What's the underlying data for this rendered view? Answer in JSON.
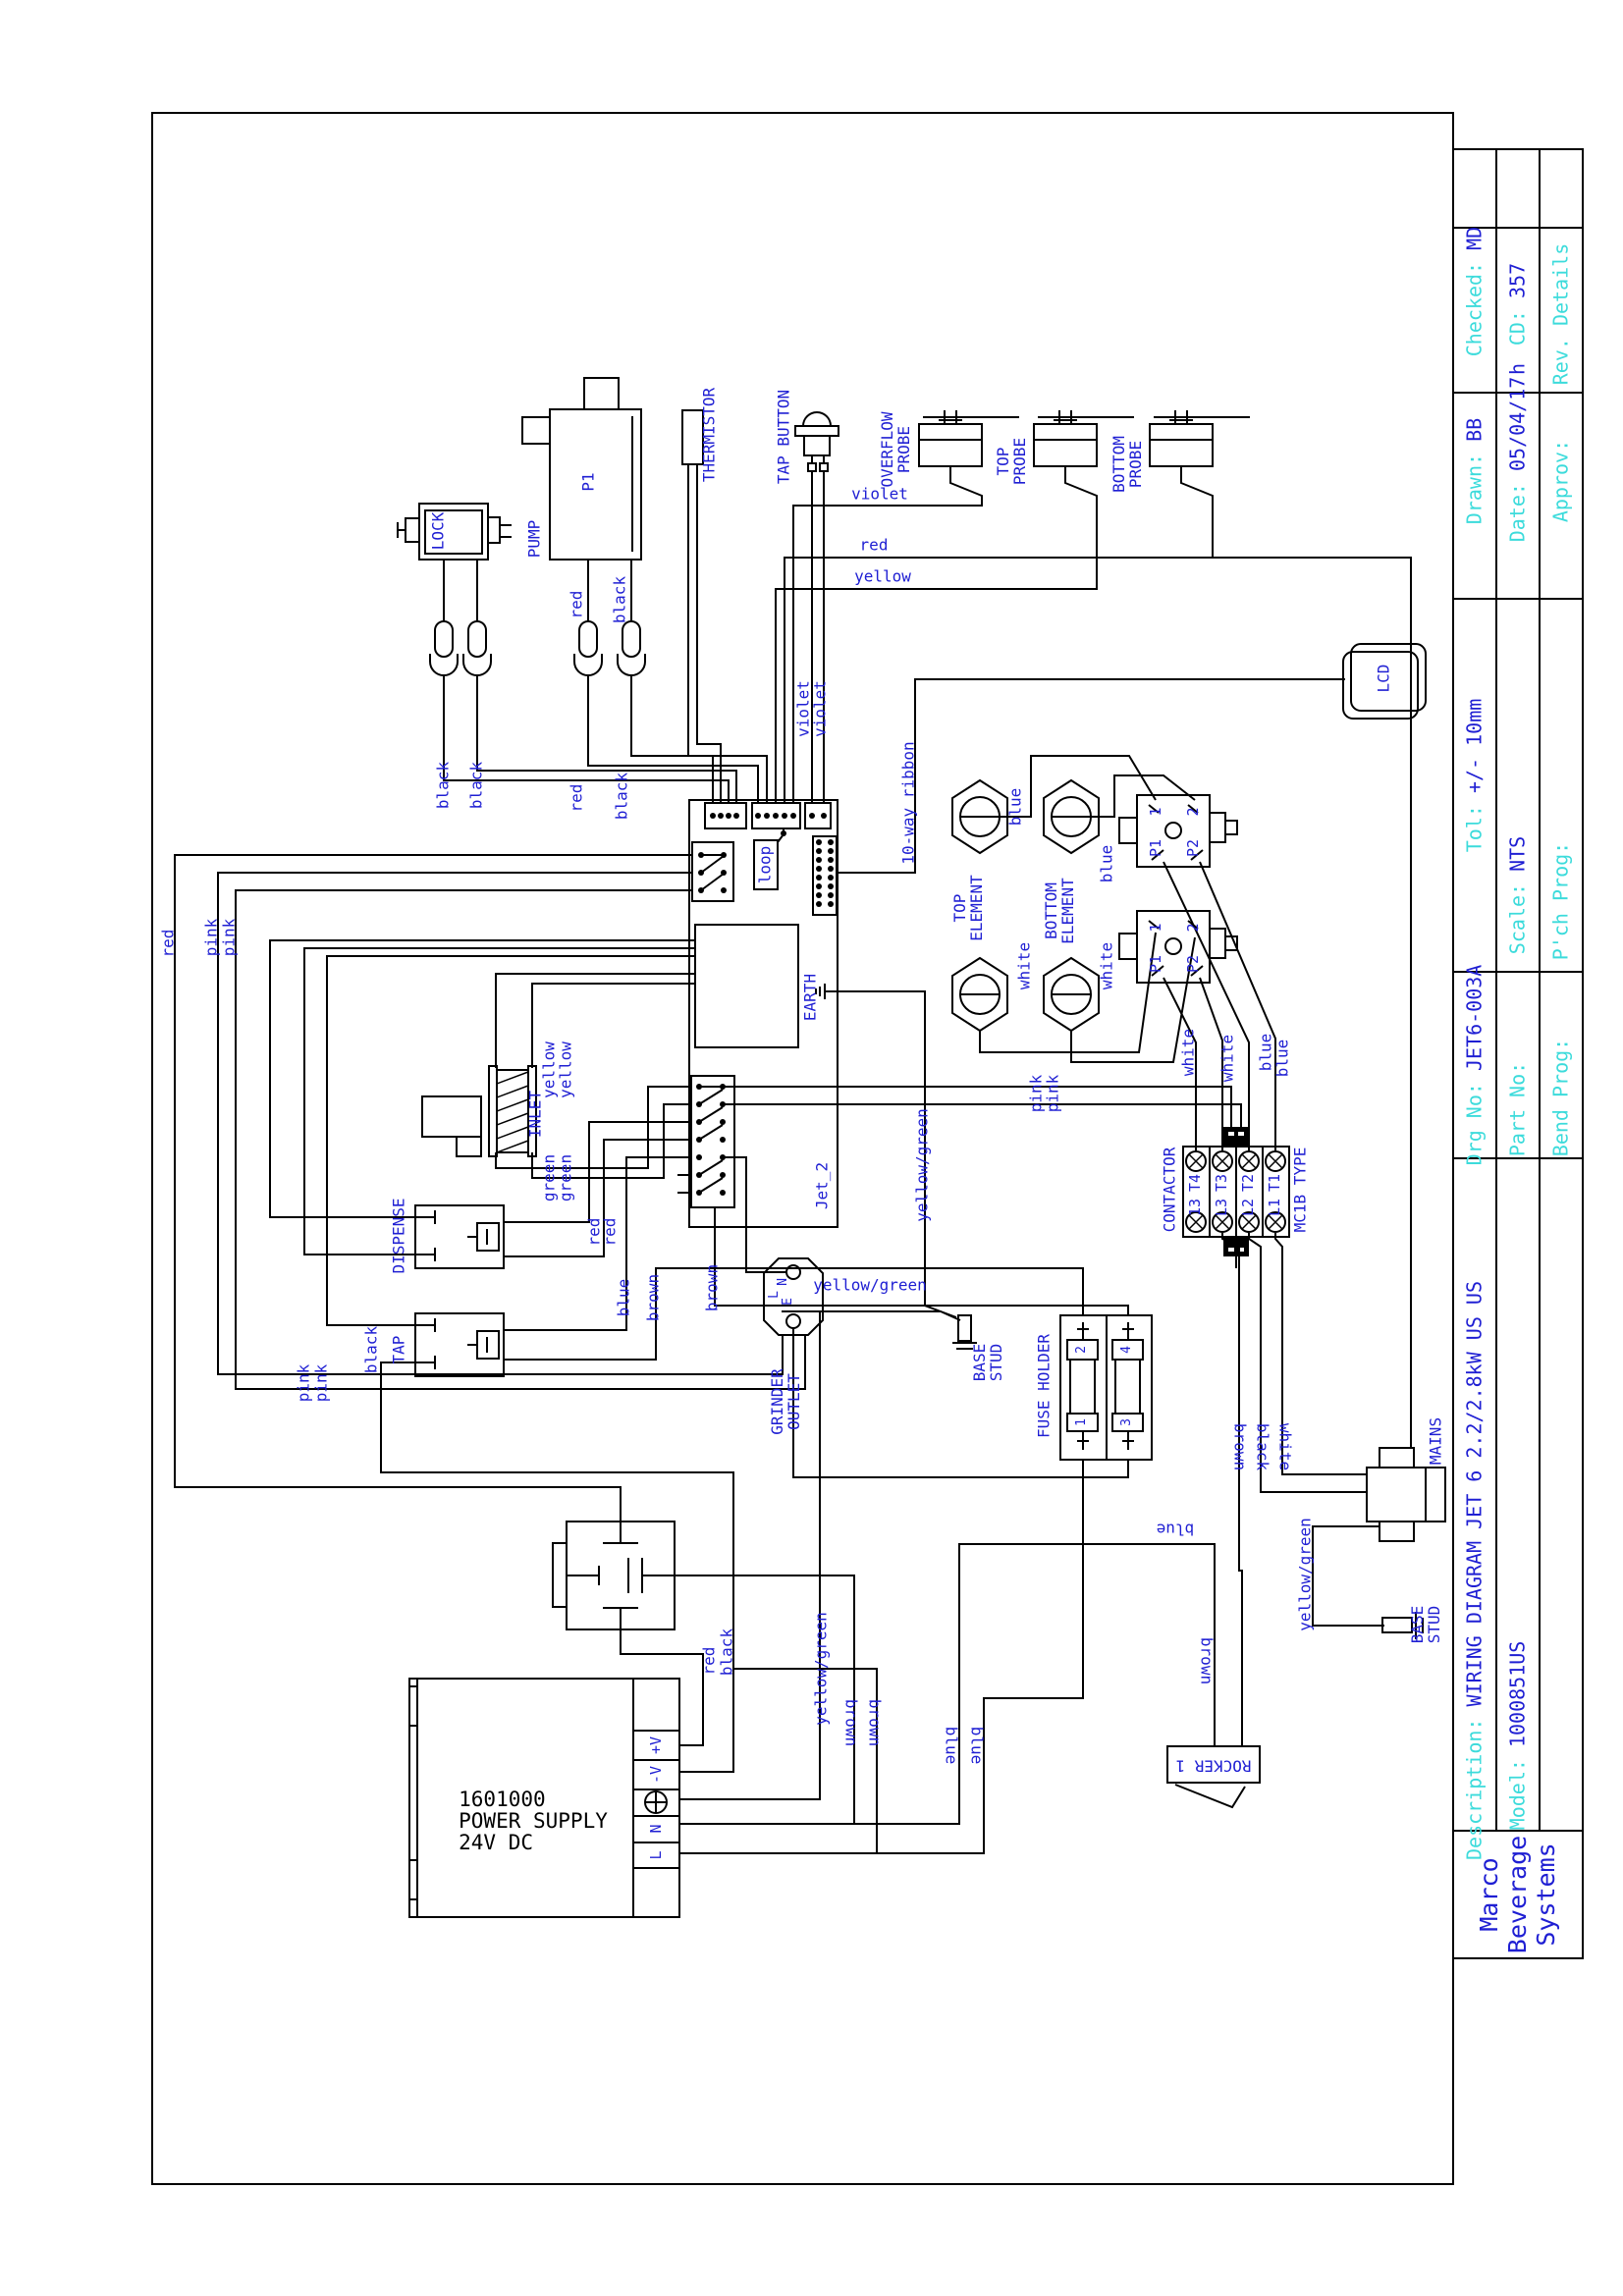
{
  "title_block": {
    "rev_details": "Rev. Details",
    "checked_label": "Checked:",
    "checked_value": "MD",
    "cd_label": "CD:",
    "cd_value": "357",
    "date_suffix": "h",
    "drawn_label": "Drawn:",
    "drawn_value": "BB",
    "date_label": "Date:",
    "date_value": "05/04/17",
    "approv_label": "Approv:",
    "tol_label": "Tol:",
    "tol_value": "+/- 10mm",
    "scale_label": "Scale:",
    "scale_value": "NTS",
    "pch_prog_label": "P'ch Prog:",
    "drg_no_label": "Drg No:",
    "drg_no_value": "JET6-003A",
    "part_no_label": "Part No:",
    "bend_prog_label": "Bend Prog:",
    "description_label": "Description:",
    "description_value": "WIRING DIAGRAM JET 6 2.2/2.8kW US US",
    "model_label": "Model:",
    "model_value": "1000851US",
    "company": "Marco\nBeverage\nSystems"
  },
  "components": {
    "lock": "LOCK",
    "pump": "PUMP",
    "pump_id": "P1",
    "thermistor": "THERMISTOR",
    "tap_button": "TAP BUTTON",
    "overflow_probe": "OVERFLOW\nPROBE",
    "top_probe": "TOP\nPROBE",
    "bottom_probe": "BOTTOM\nPROBE",
    "ribbon": "10-way ribbon",
    "loop": "loop",
    "earth": "EARTH",
    "top_element": "TOP\nELEMENT",
    "bottom_element": "BOTTOM\nELEMENT",
    "lcd": "LCD",
    "jet2": "Jet_2",
    "grinder_outlet": "GRINDER\nOUTLET",
    "term_l": "L",
    "term_n": "N",
    "term_e": "E",
    "cut_1": "1",
    "cut_2": "2",
    "cut_p1": "P1",
    "cut_p2": "P2",
    "contactor": "CONTACTOR",
    "contactor_type": "MC1B TYPE",
    "t4": "T4",
    "t3": "T3",
    "t2": "T2",
    "t1": "T1",
    "c13": "13",
    "l3": "L3",
    "l2": "L2",
    "l1": "L1",
    "inlet": "INLET",
    "dispense": "DISPENSE",
    "tap": "TAP",
    "fuse_holder": "FUSE HOLDER",
    "fuse_1": "1",
    "fuse_2": "2",
    "fuse_3": "3",
    "fuse_4": "4",
    "mains": "MAINS",
    "rocker": "ROCKER 1",
    "base_stud": "BASE\nSTUD",
    "power_supply": {
      "text": "1601000\nPOWER SUPPLY\n24V DC",
      "term_pv": "+V",
      "term_nv": "-V",
      "term_n": "N",
      "term_l": "L"
    }
  },
  "wire_colors": {
    "black": "black",
    "red": "red",
    "violet": "violet",
    "yellow": "yellow",
    "green": "green",
    "blue": "blue",
    "brown": "brown",
    "white": "white",
    "pink": "pink",
    "yellow_green": "yellow/green"
  },
  "colors": {
    "label_blue": "#1f1fd3",
    "label_cyan": "#3cdbdb",
    "line": "#000000"
  }
}
